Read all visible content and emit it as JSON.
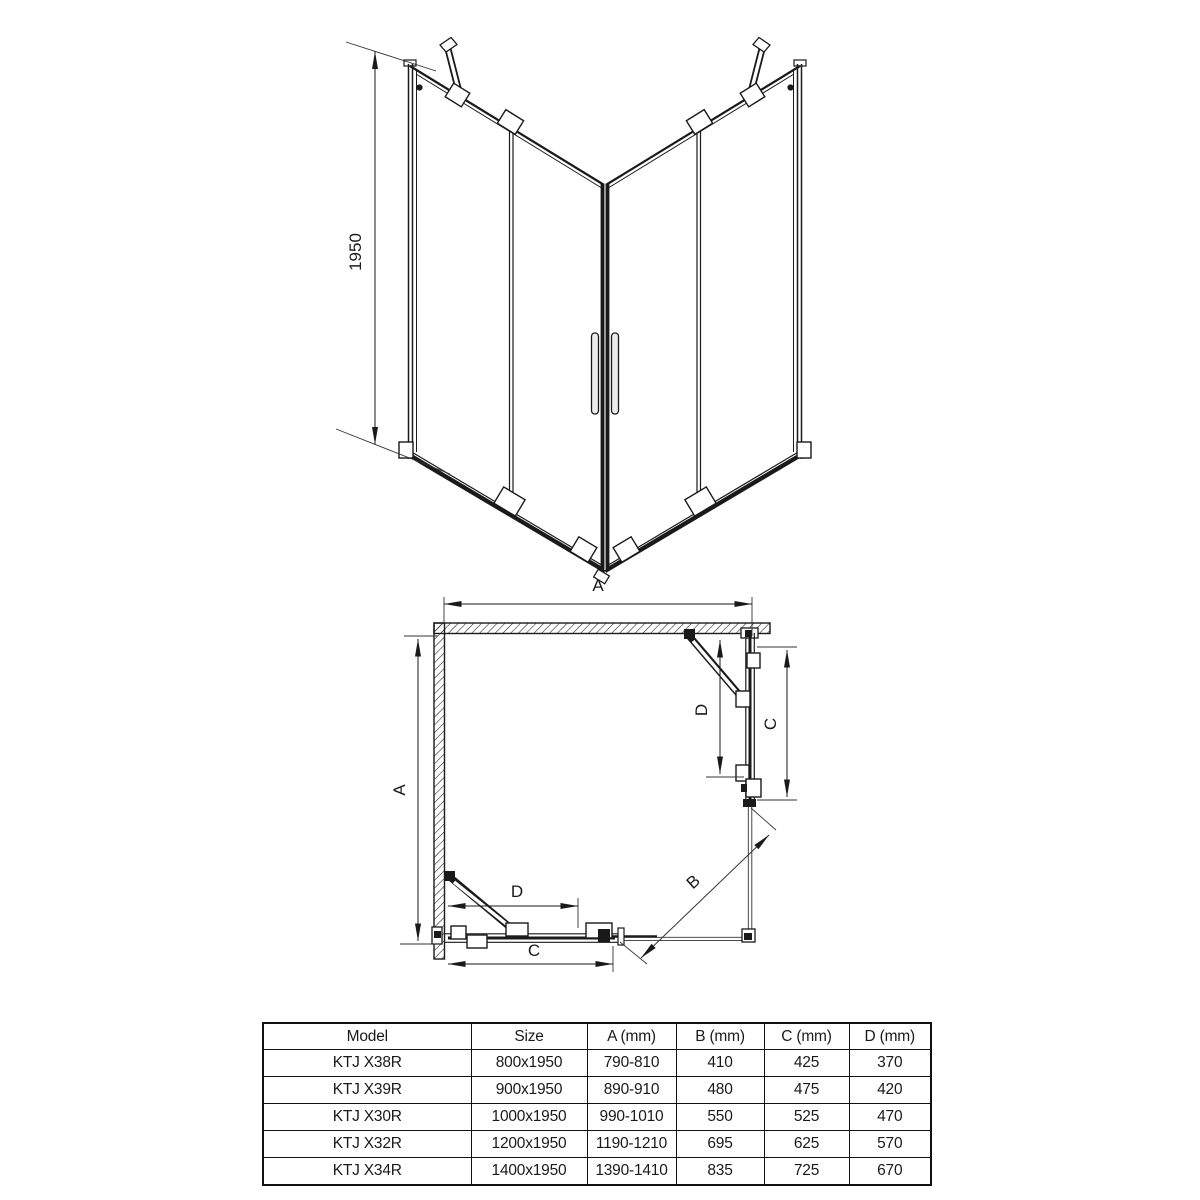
{
  "front_view": {
    "height_label": "1950"
  },
  "plan_view": {
    "width_label": "A",
    "depth_label": "A",
    "diagonal_label": "B",
    "side_d_label": "D",
    "side_c_label": "C",
    "door_d_label": "D",
    "door_c_label": "C"
  },
  "table": {
    "headers": [
      "Model",
      "Size",
      "A (mm)",
      "B (mm)",
      "C (mm)",
      "D (mm)"
    ],
    "rows": [
      {
        "model": "KTJ X38R",
        "size": "800x1950",
        "a": "790-810",
        "b": "410",
        "c": "425",
        "d": "370"
      },
      {
        "model": "KTJ X39R",
        "size": "900x1950",
        "a": "890-910",
        "b": "480",
        "c": "475",
        "d": "420"
      },
      {
        "model": "KTJ X30R",
        "size": "1000x1950",
        "a": "990-1010",
        "b": "550",
        "c": "525",
        "d": "470"
      },
      {
        "model": "KTJ X32R",
        "size": "1200x1950",
        "a": "1190-1210",
        "b": "695",
        "c": "625",
        "d": "570"
      },
      {
        "model": "KTJ X34R",
        "size": "1400x1950",
        "a": "1390-1410",
        "b": "835",
        "c": "725",
        "d": "670"
      }
    ]
  },
  "colors": {
    "line": "#1a1a1a",
    "background": "#ffffff"
  }
}
